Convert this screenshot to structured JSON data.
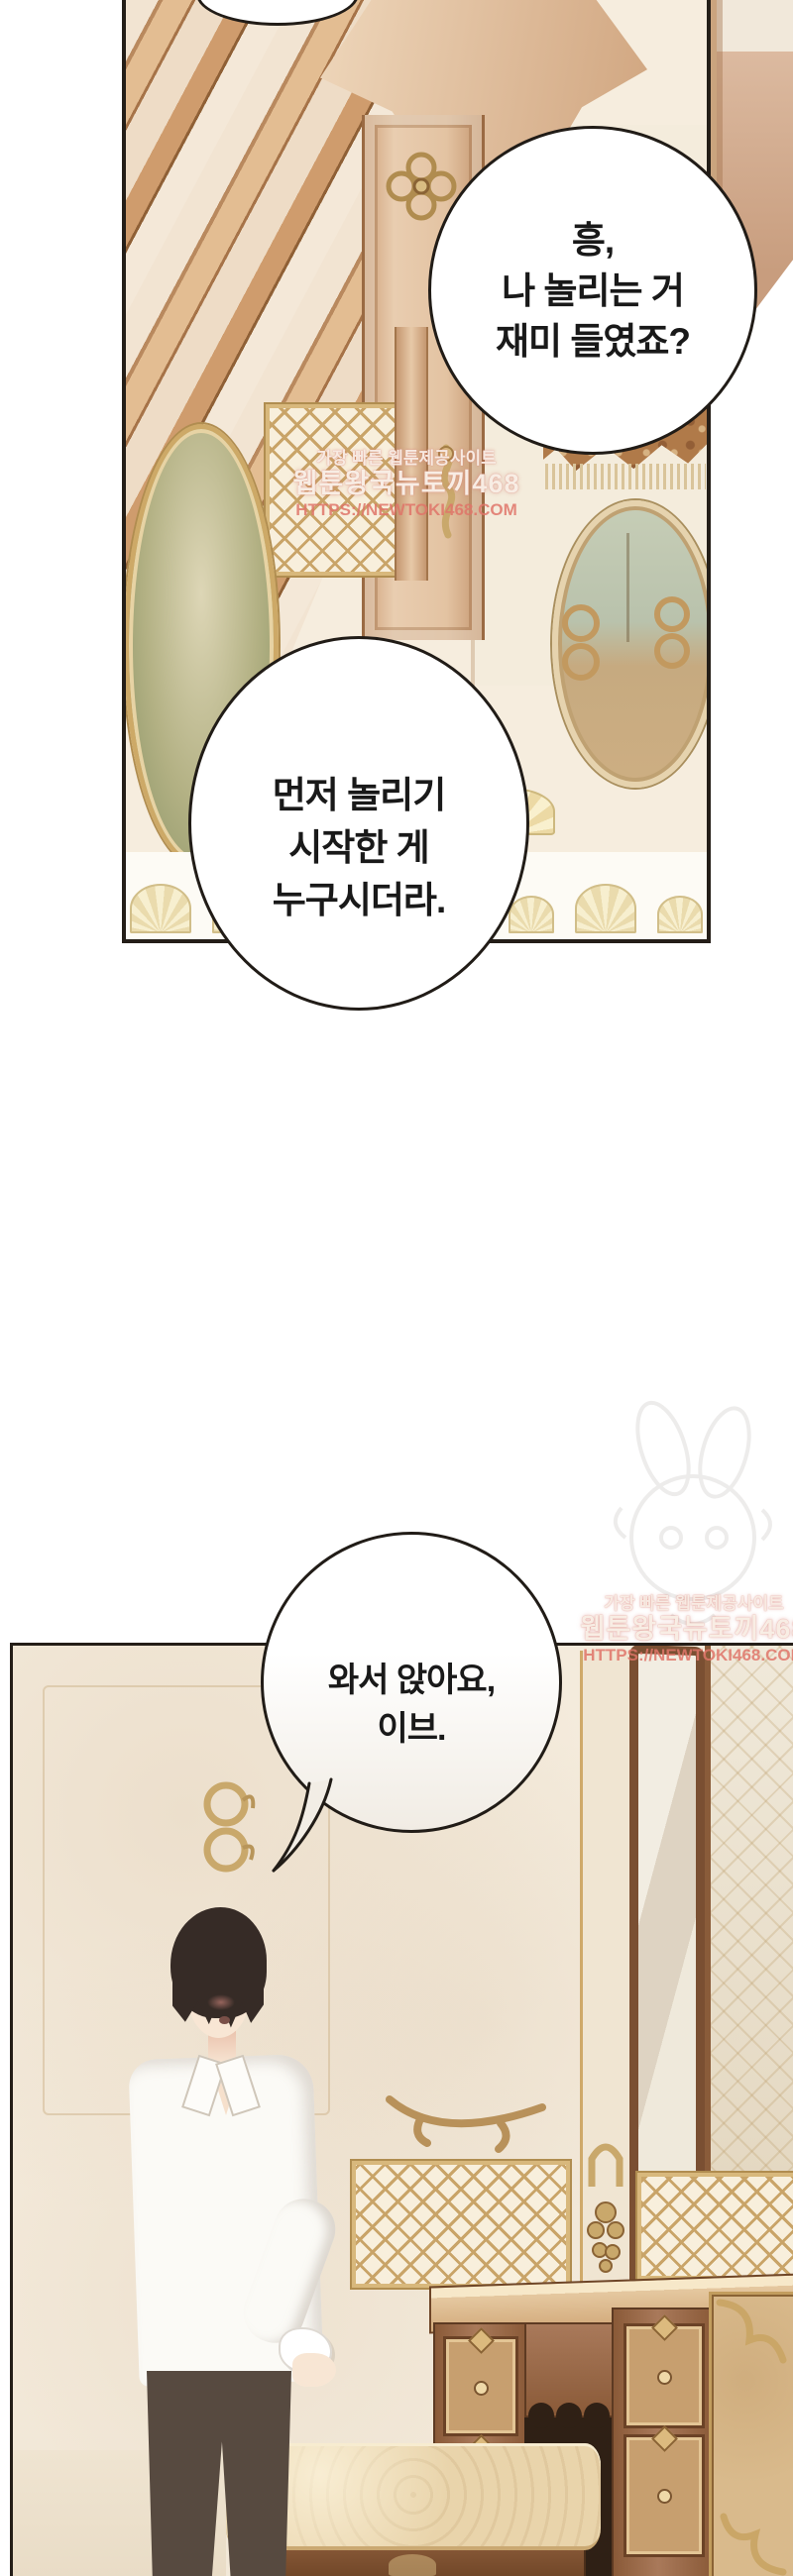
{
  "bubbles": {
    "bubble1": {
      "line1": "흥,",
      "line2": "나 놀리는 거",
      "line3": "재미 들였죠?"
    },
    "bubble2": {
      "line1": "먼저 놀리기",
      "line2": "시작한 게",
      "line3": "누구시더라."
    },
    "bubble3": {
      "line1": "와서 앉아요,",
      "line2": "이브."
    }
  },
  "watermark": {
    "line1": "가장 빠른 웹툰제공사이트",
    "line2": "웹툰왕국뉴토끼468",
    "line3": "HTTPS://NEWTOKI468.COM"
  },
  "colors": {
    "panel_border": "#241e18",
    "bubble_border": "#211c17",
    "bubble_text": "#191919",
    "gold": "#c9a86b",
    "wood": "#8a5a38",
    "wall_cream": "#f4ebdc",
    "watermark_pink": "#df7468"
  }
}
